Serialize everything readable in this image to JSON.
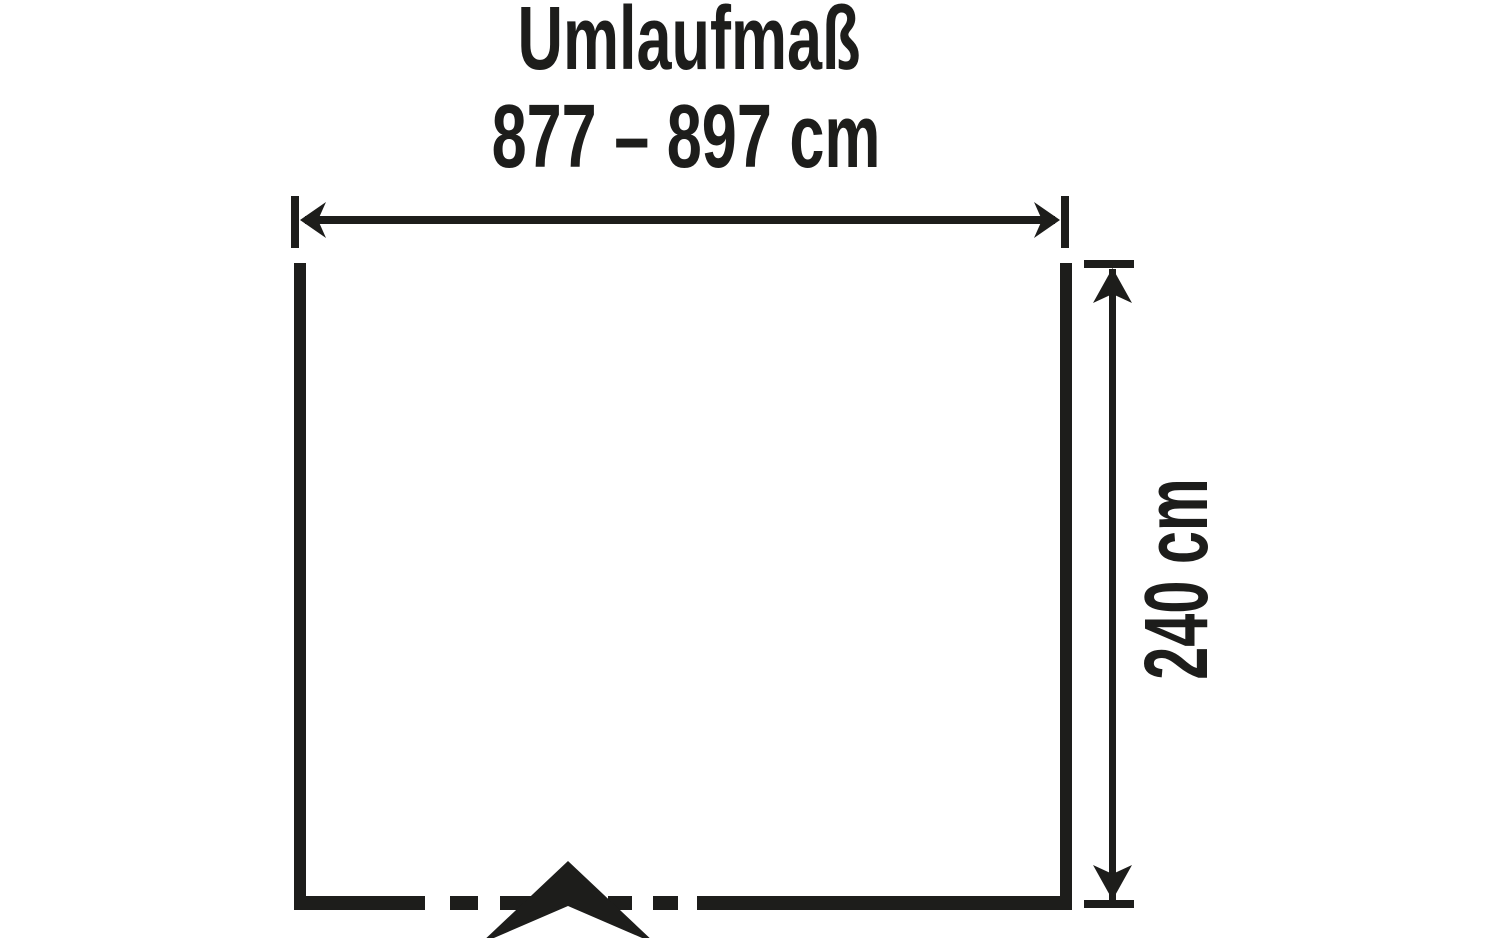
{
  "diagram": {
    "title": "Umlaufmaß",
    "width_dimension": {
      "label": "877 – 897 cm",
      "min_cm": 877,
      "max_cm": 897,
      "unit": "cm"
    },
    "height_dimension": {
      "label": "240 cm",
      "value_cm": 240,
      "unit": "cm"
    },
    "colors": {
      "ink": "#1d1d1b",
      "background": "#ffffff"
    }
  }
}
